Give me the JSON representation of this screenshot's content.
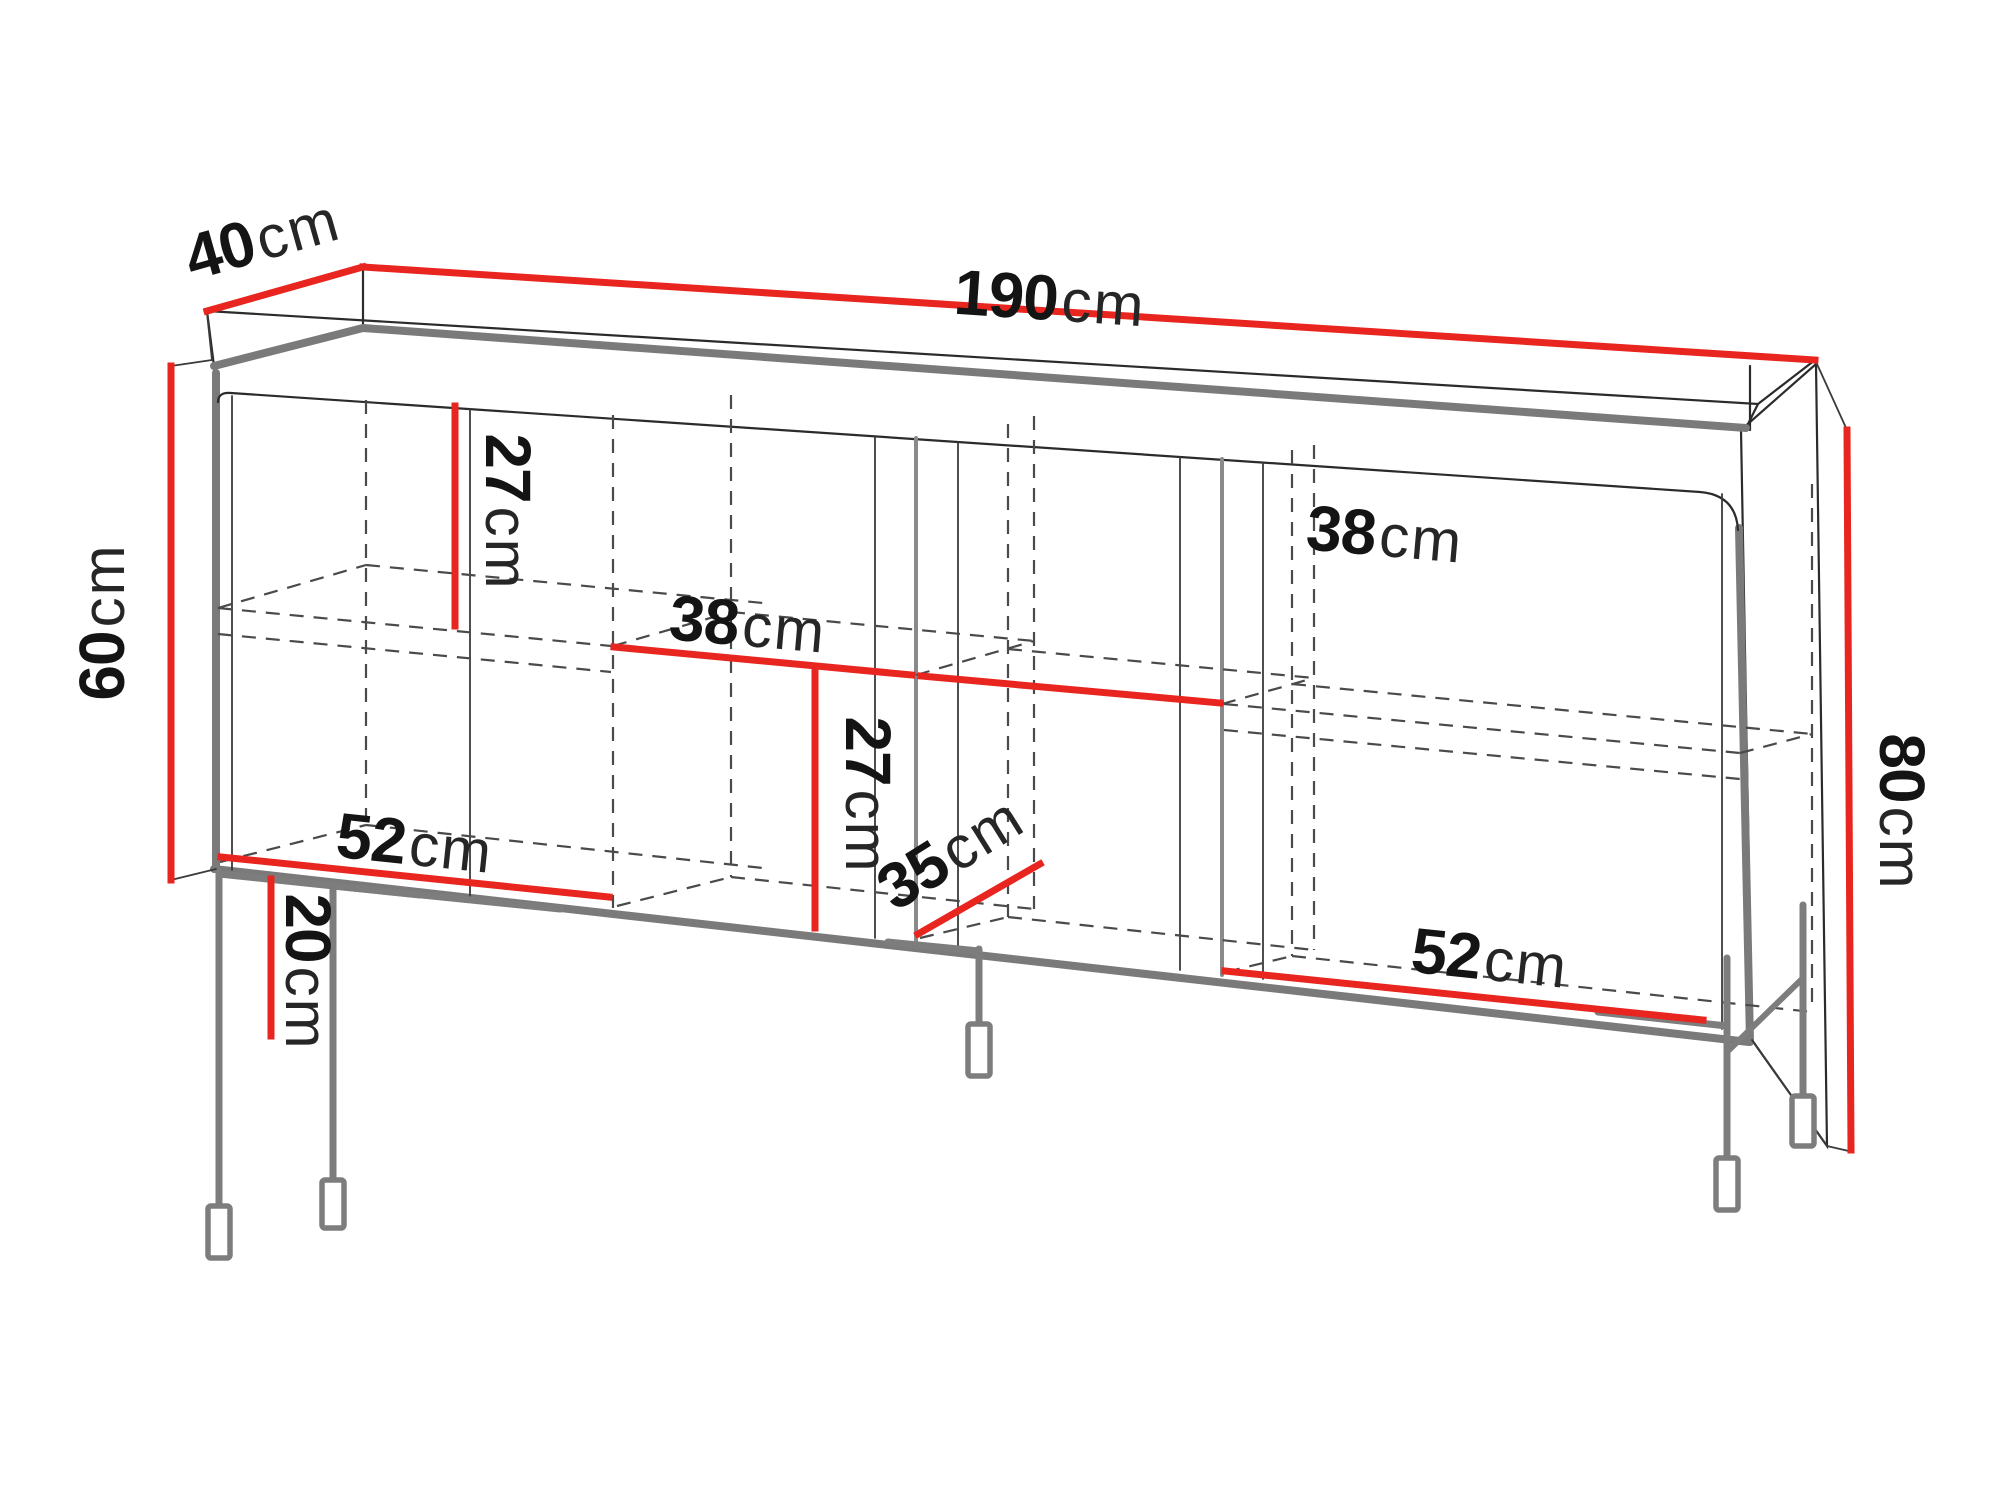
{
  "diagram": {
    "type": "furniture-dimension-diagram",
    "subject": "four-door sideboard on metal legs",
    "unit": "cm",
    "colors": {
      "dimension_line": "#e8251f",
      "outline": "#2b2b2b",
      "metal_gray": "#7d7d7d",
      "background": "#ffffff"
    },
    "dimensions": {
      "total_width": {
        "value": "190",
        "unit": "cm"
      },
      "top_depth": {
        "value": "40",
        "unit": "cm"
      },
      "body_height": {
        "value": "60",
        "unit": "cm"
      },
      "total_height": {
        "value": "80",
        "unit": "cm"
      },
      "upper_compartment_height": {
        "value": "27",
        "unit": "cm"
      },
      "lower_compartment_height": {
        "value": "27",
        "unit": "cm"
      },
      "middle_section_width_left": {
        "value": "38",
        "unit": "cm"
      },
      "middle_section_width_right": {
        "value": "38",
        "unit": "cm"
      },
      "interior_depth": {
        "value": "35",
        "unit": "cm"
      },
      "outer_section_width_left": {
        "value": "52",
        "unit": "cm"
      },
      "outer_section_width_right": {
        "value": "52",
        "unit": "cm"
      },
      "leg_height": {
        "value": "20",
        "unit": "cm"
      }
    }
  }
}
